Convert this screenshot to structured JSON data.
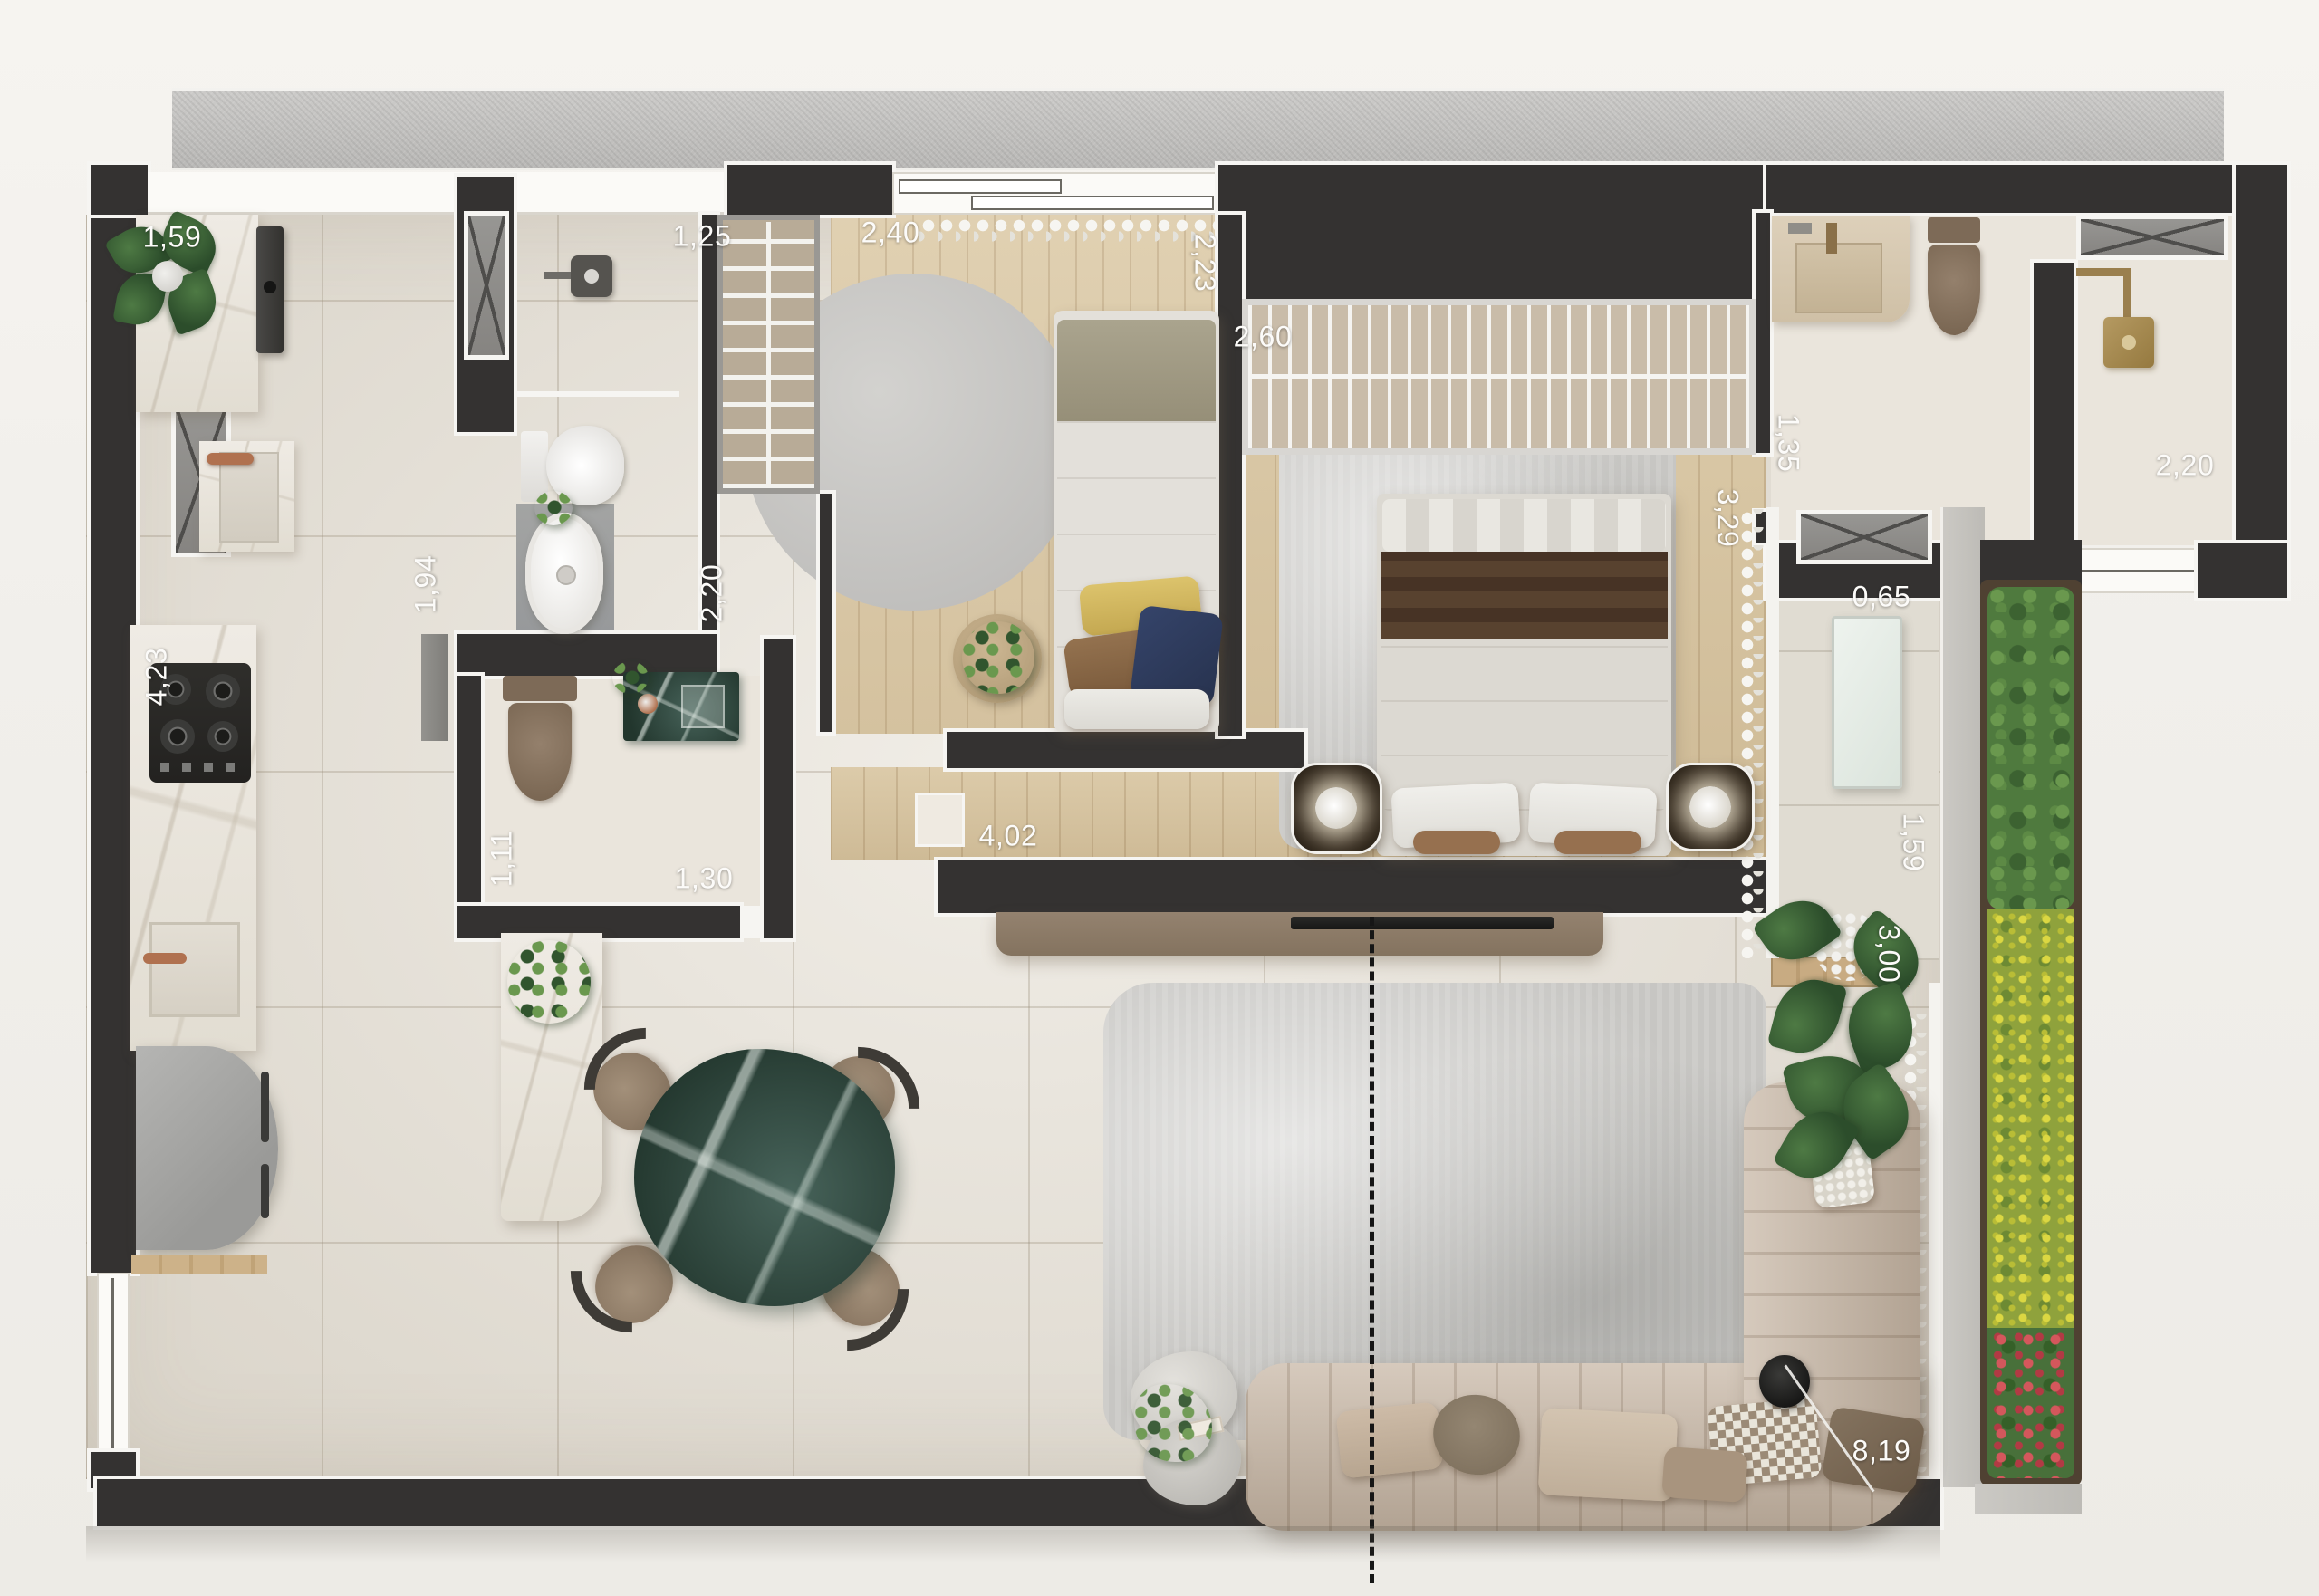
{
  "plan_title": "apartment-floor-plan",
  "labels": [
    {
      "id": "dim-kitchen-corner",
      "text": "1,59"
    },
    {
      "id": "dim-bath1-width",
      "text": "1,25"
    },
    {
      "id": "dim-bedroom2-width",
      "text": "2,40"
    },
    {
      "id": "dim-bedroom2-depth",
      "text": "2,23"
    },
    {
      "id": "dim-wardrobe-width",
      "text": "2,60"
    },
    {
      "id": "dim-masterbath-door",
      "text": "1,35"
    },
    {
      "id": "dim-wc-width",
      "text": "2,20"
    },
    {
      "id": "dim-master-depth",
      "text": "3,29"
    },
    {
      "id": "dim-balcony-counter",
      "text": "0,65"
    },
    {
      "id": "dim-bath1-depth",
      "text": "1,94"
    },
    {
      "id": "dim-bath1-width2",
      "text": "2,20"
    },
    {
      "id": "dim-kitchen-length",
      "text": "4,23"
    },
    {
      "id": "dim-lavabo-width",
      "text": "1,11"
    },
    {
      "id": "dim-lavabo-depth",
      "text": "1,30"
    },
    {
      "id": "dim-master-width",
      "text": "4,02"
    },
    {
      "id": "dim-balcony-width",
      "text": "1,59"
    },
    {
      "id": "dim-balcony-depth",
      "text": "3,00"
    },
    {
      "id": "dim-living-length",
      "text": "8,19"
    }
  ],
  "palette": {
    "background": "#f1efeb",
    "hall_band": "#c4c3c1",
    "wall": "#343231",
    "wall_trim": "#f6f5f2",
    "tile_floor": "#e9e4da",
    "wood_floor": "#d8c5a0",
    "rug": "#c7c6c3",
    "sofa": "#c6b5a3",
    "dining_table_marble": "#31493d",
    "marble_counter": "#eae6df",
    "shrub_green": "#4f7a3e",
    "flower_yellow": "#dbd742",
    "flower_red": "#d4575c",
    "copper_fixture": "#b0714f",
    "brass_fixture": "#ab8d58",
    "label_text": "#fcfbf9"
  }
}
